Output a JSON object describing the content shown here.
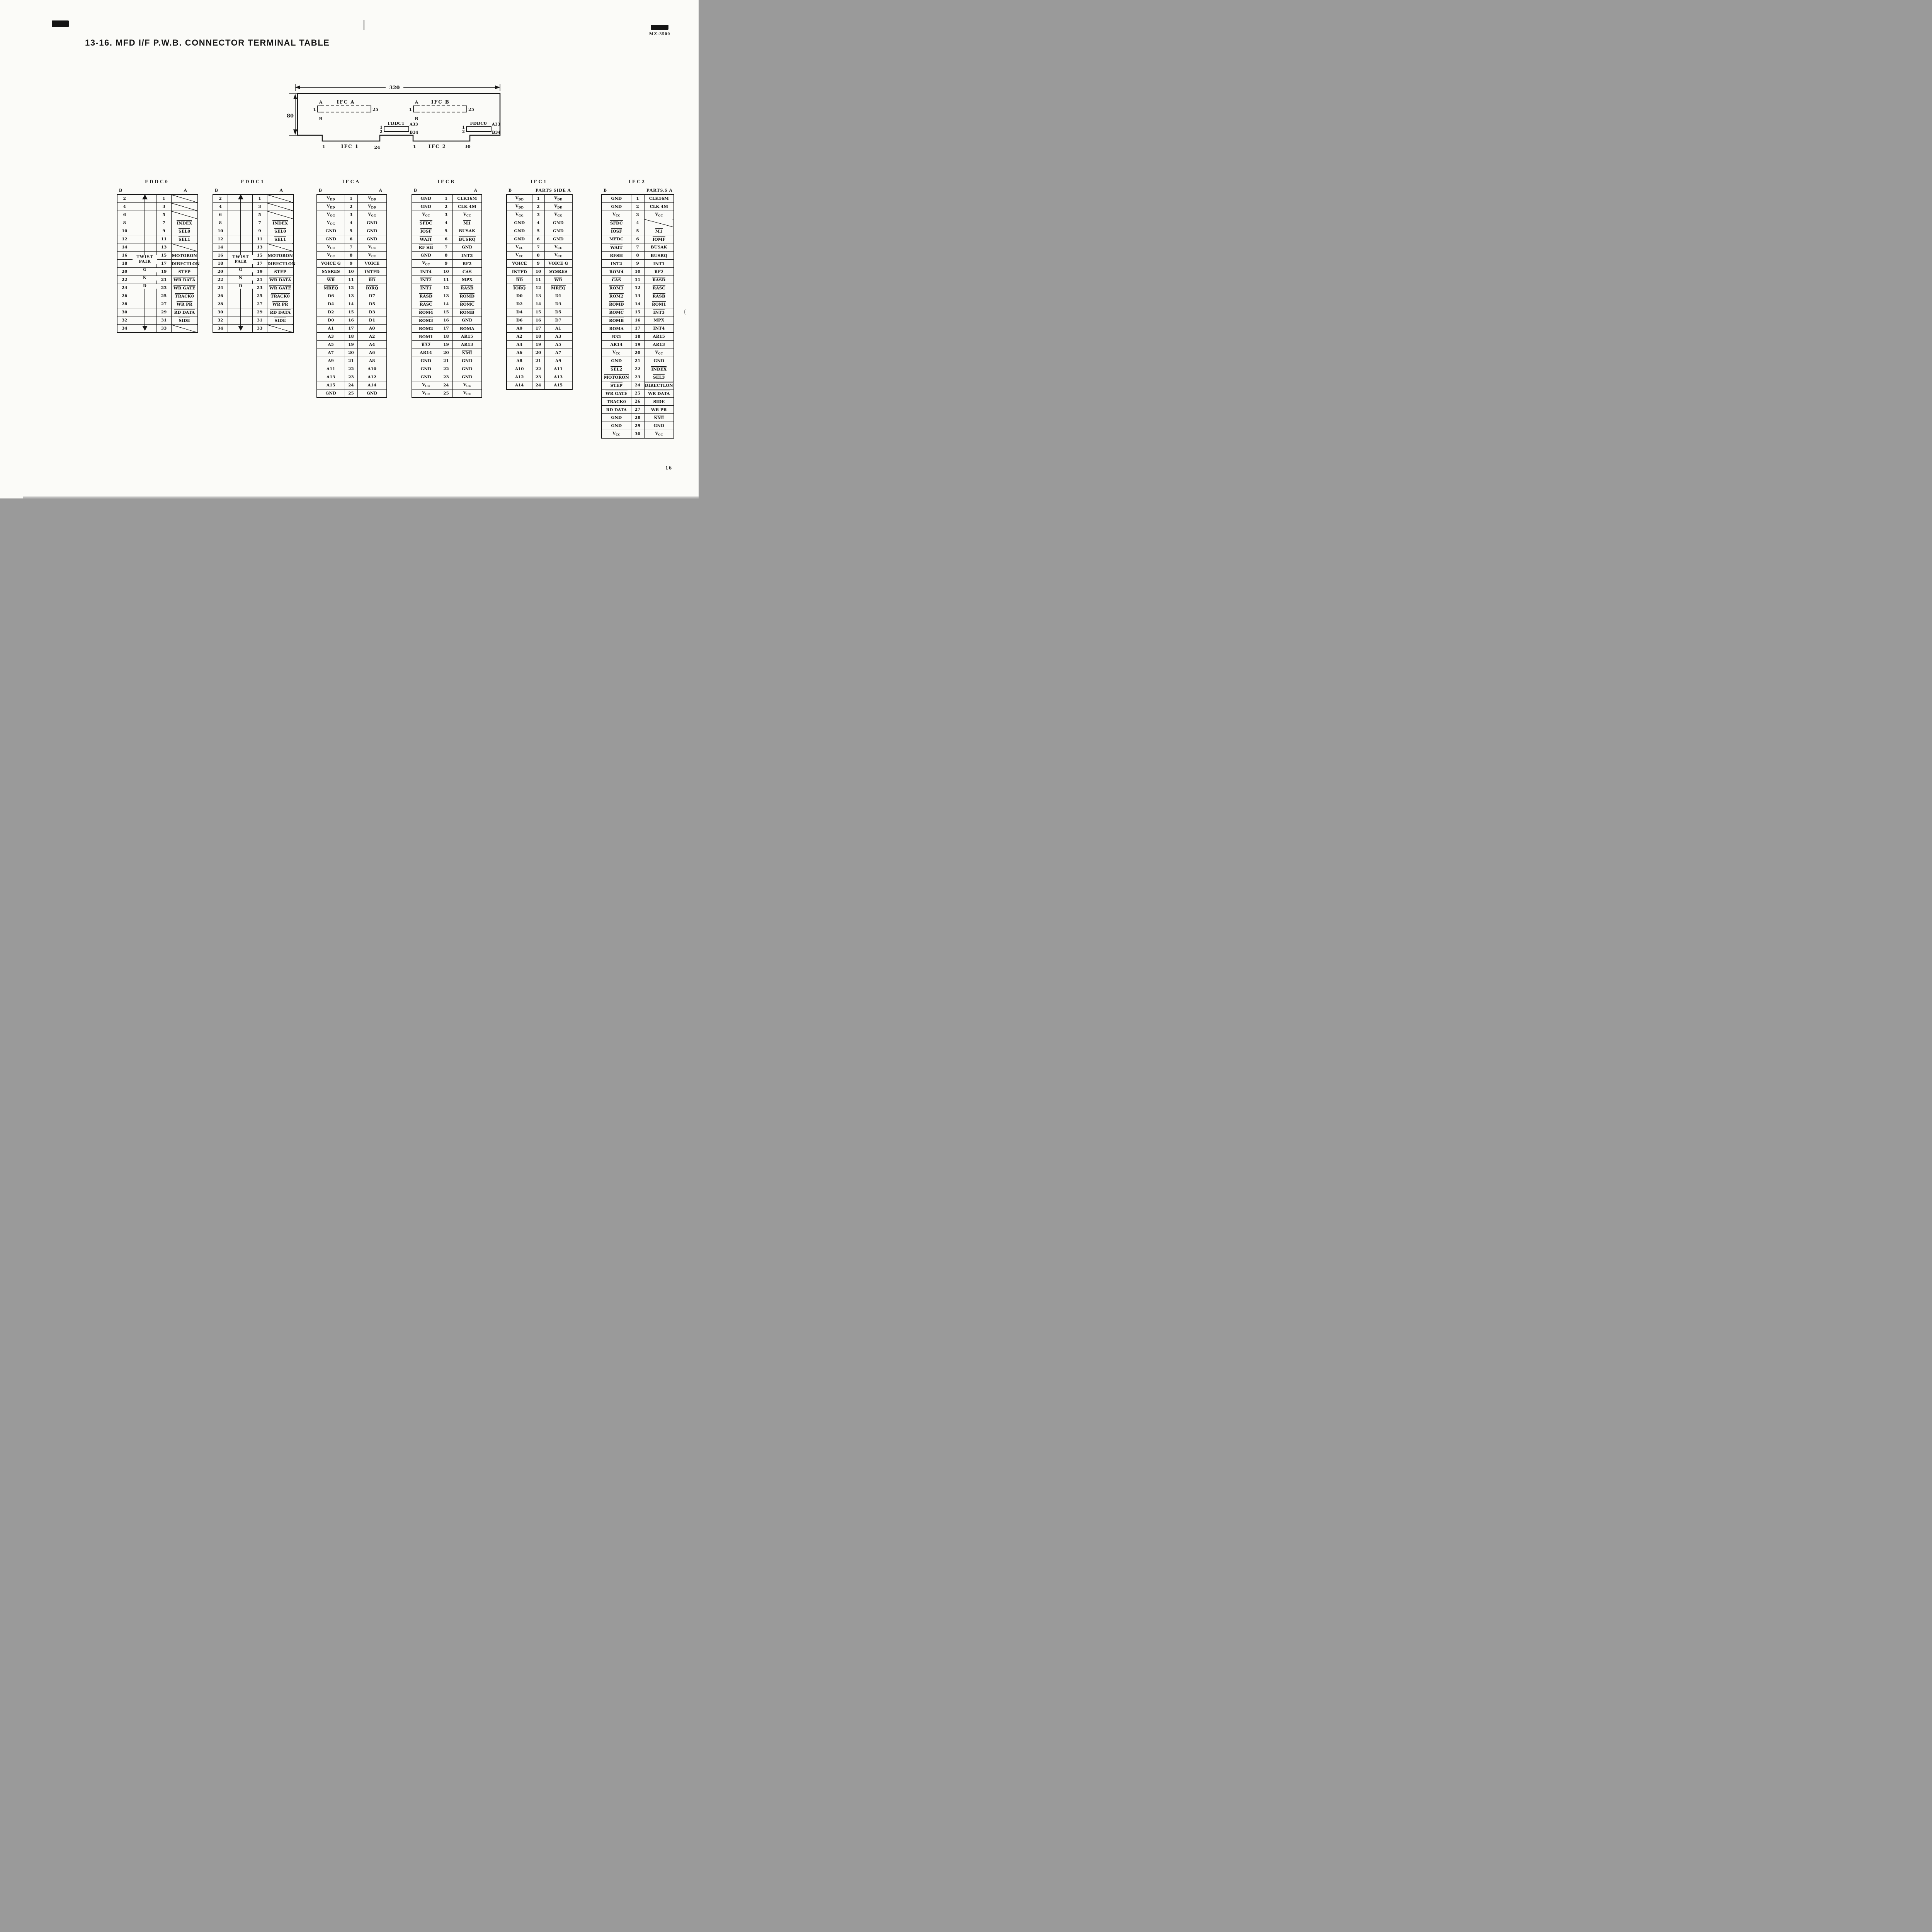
{
  "page": {
    "title": "13-16. MFD I/F P.W.B. CONNECTOR TERMINAL TABLE",
    "model": "MZ-3500",
    "page_number": "16"
  },
  "diagram": {
    "dim_width": "320",
    "dim_height": "80",
    "ifca": {
      "name": "IFC A",
      "side_a": "A",
      "side_b": "B",
      "pin_first": "1",
      "pin_last": "25"
    },
    "ifcb": {
      "name": "IFC B",
      "side_a": "A",
      "side_b": "B",
      "pin_first": "1",
      "pin_last": "25"
    },
    "fddc1": {
      "name": "FDDC1",
      "pin1": "1",
      "pin2": "2",
      "a33": "A33",
      "b34": "B34"
    },
    "fddc0": {
      "name": "FDDC0",
      "pin1": "1",
      "pin2": "2",
      "a33": "A33",
      "b34": "B34"
    },
    "ifc1": {
      "name": "IFC 1",
      "pin_first": "1",
      "pin_last": "24"
    },
    "ifc2": {
      "name": "IFC 2",
      "pin_first": "1",
      "pin_last": "30"
    }
  },
  "tables": [
    {
      "id": "fddc0",
      "kind": "fddc",
      "title": "FDDC0",
      "head_left": "B",
      "head_right": "A",
      "twist": {
        "line1": "TWIST",
        "line2": "PAIR",
        "g": "G",
        "n": "N",
        "d": "D"
      },
      "rows": [
        [
          "2",
          "1",
          "/"
        ],
        [
          "4",
          "3",
          "/"
        ],
        [
          "6",
          "5",
          "/"
        ],
        [
          "8",
          "7",
          "^INDEX"
        ],
        [
          "10",
          "9",
          "^SEL0"
        ],
        [
          "12",
          "11",
          "^SEL1"
        ],
        [
          "14",
          "13",
          "/"
        ],
        [
          "16",
          "15",
          "^MOTORON"
        ],
        [
          "18",
          "17",
          "^DIRECTLON"
        ],
        [
          "20",
          "19",
          "^STEP"
        ],
        [
          "22",
          "21",
          "^WR DATA"
        ],
        [
          "24",
          "23",
          "^WR GATE"
        ],
        [
          "26",
          "25",
          "^TRACK0"
        ],
        [
          "28",
          "27",
          "^WR PR"
        ],
        [
          "30",
          "29",
          "^RD DATA"
        ],
        [
          "32",
          "31",
          "^SIDE"
        ],
        [
          "34",
          "33",
          "/"
        ]
      ]
    },
    {
      "id": "fddc1",
      "kind": "fddc",
      "title": "FDDC1",
      "head_left": "B",
      "head_right": "A",
      "twist": {
        "line1": "TWIST",
        "line2": "PAIR",
        "g": "G",
        "n": "N",
        "d": "D"
      },
      "rows": [
        [
          "2",
          "1",
          "/"
        ],
        [
          "4",
          "3",
          "/"
        ],
        [
          "6",
          "5",
          "/"
        ],
        [
          "8",
          "7",
          "^INDEX"
        ],
        [
          "10",
          "9",
          "^SEL0"
        ],
        [
          "12",
          "11",
          "^SEL1"
        ],
        [
          "14",
          "13",
          "/"
        ],
        [
          "16",
          "15",
          "^MOTORON"
        ],
        [
          "18",
          "17",
          "^DIRECTLON"
        ],
        [
          "20",
          "19",
          "^STEP"
        ],
        [
          "22",
          "21",
          "^WR DATA"
        ],
        [
          "24",
          "23",
          "^WR GATE"
        ],
        [
          "26",
          "25",
          "^TRACK0"
        ],
        [
          "28",
          "27",
          "^WR PR"
        ],
        [
          "30",
          "29",
          "^RD DATA"
        ],
        [
          "32",
          "31",
          "^SIDE"
        ],
        [
          "34",
          "33",
          "/"
        ]
      ]
    },
    {
      "id": "ifca",
      "kind": "ifc",
      "title": "IFCA",
      "head_left": "B",
      "head_right": "A",
      "rows": [
        [
          "V_DD",
          "1",
          "V_DD"
        ],
        [
          "V_DD",
          "2",
          "V_DD"
        ],
        [
          "V_GG",
          "3",
          "V_GG"
        ],
        [
          "V_GG",
          "4",
          "GND"
        ],
        [
          "GND",
          "5",
          "GND"
        ],
        [
          "GND",
          "6",
          "GND"
        ],
        [
          "V_CC",
          "7",
          "V_CC"
        ],
        [
          "V_CC",
          "8",
          "V_CC"
        ],
        [
          "VOICE G",
          "9",
          "VOICE"
        ],
        [
          "SYSRES",
          "10",
          "^INTFD"
        ],
        [
          "^WR",
          "11",
          "^RD"
        ],
        [
          "^MREQ",
          "12",
          "^IORQ"
        ],
        [
          "D6",
          "13",
          "D7"
        ],
        [
          "D4",
          "14",
          "D5"
        ],
        [
          "D2",
          "15",
          "D3"
        ],
        [
          "D0",
          "16",
          "D1"
        ],
        [
          "A1",
          "17",
          "A0"
        ],
        [
          "A3",
          "18",
          "A2"
        ],
        [
          "A5",
          "19",
          "A4"
        ],
        [
          "A7",
          "20",
          "A6"
        ],
        [
          "A9",
          "21",
          "A8"
        ],
        [
          "A11",
          "22",
          "A10"
        ],
        [
          "A13",
          "23",
          "A12"
        ],
        [
          "A15",
          "24",
          "A14"
        ],
        [
          "GND",
          "25",
          "GND"
        ]
      ]
    },
    {
      "id": "ifcb",
      "kind": "ifc",
      "title": "IFCB",
      "head_left": "B",
      "head_right": "A",
      "rows": [
        [
          "GND",
          "1",
          "CLK16M"
        ],
        [
          "GND",
          "2",
          "CLK 4M"
        ],
        [
          "V_CC",
          "3",
          "V_CC"
        ],
        [
          "^SFDC",
          "4",
          "^M1"
        ],
        [
          "^IOSF",
          "5",
          "BUSAK"
        ],
        [
          "^WAIT",
          "6",
          "^BUSRQ"
        ],
        [
          "^RF SH",
          "7",
          "GND"
        ],
        [
          "GND",
          "8",
          "^INT3"
        ],
        [
          "V_CC",
          "9",
          "^RF2"
        ],
        [
          "^INT4",
          "10",
          "^CAS"
        ],
        [
          "^INT2",
          "11",
          "MPX"
        ],
        [
          "^INT1",
          "12",
          "^RASB"
        ],
        [
          "^RASD",
          "13",
          "^ROMD"
        ],
        [
          "^RASC",
          "14",
          "^ROMC"
        ],
        [
          "^ROM4",
          "15",
          "^ROMB"
        ],
        [
          "^ROM3",
          "16",
          "GND"
        ],
        [
          "^ROM2",
          "17",
          "^ROMA"
        ],
        [
          "^ROM1",
          "18",
          "AR15"
        ],
        [
          "^R32",
          "19",
          "AR13"
        ],
        [
          "AR14",
          "20",
          "^NMI"
        ],
        [
          "GND",
          "21",
          "GND"
        ],
        [
          "GND",
          "22",
          "GND"
        ],
        [
          "GND",
          "23",
          "GND"
        ],
        [
          "V_CC",
          "24",
          "V_CC"
        ],
        [
          "V_CC",
          "25",
          "V_CC"
        ]
      ]
    },
    {
      "id": "ifc1",
      "kind": "ifc",
      "title": "IFC1",
      "head_left": "B",
      "head_right": "PARTS SIDE A",
      "rows": [
        [
          "V_DD",
          "1",
          "V_DD"
        ],
        [
          "V_DD",
          "2",
          "V_DD"
        ],
        [
          "V_GG",
          "3",
          "V_GG"
        ],
        [
          "GND",
          "4",
          "GND"
        ],
        [
          "GND",
          "5",
          "GND"
        ],
        [
          "GND",
          "6",
          "GND"
        ],
        [
          "V_CC",
          "7",
          "V_CC"
        ],
        [
          "V_CC",
          "8",
          "V_CC"
        ],
        [
          "VOICE",
          "9",
          "VOICE G"
        ],
        [
          "^INTFD",
          "10",
          "SYSRES"
        ],
        [
          "^RD",
          "11",
          "^WR"
        ],
        [
          "^IORQ",
          "12",
          "^MREQ"
        ],
        [
          "D0",
          "13",
          "D1"
        ],
        [
          "D2",
          "14",
          "D3"
        ],
        [
          "D4",
          "15",
          "D5"
        ],
        [
          "D6",
          "16",
          "D7"
        ],
        [
          "A0",
          "17",
          "A1"
        ],
        [
          "A2",
          "18",
          "A3"
        ],
        [
          "A4",
          "19",
          "A5"
        ],
        [
          "A6",
          "20",
          "A7"
        ],
        [
          "A8",
          "21",
          "A9"
        ],
        [
          "A10",
          "22",
          "A11"
        ],
        [
          "A12",
          "23",
          "A13"
        ],
        [
          "A14",
          "24",
          "A15"
        ]
      ]
    },
    {
      "id": "ifc2",
      "kind": "ifc",
      "title": "IFC2",
      "head_left": "B",
      "head_right": "PARTS.S A",
      "rows": [
        [
          "GND",
          "1",
          "CLK16M"
        ],
        [
          "GND",
          "2",
          "CLK 4M"
        ],
        [
          "V_CC",
          "3",
          "V_CC"
        ],
        [
          "^SFDC",
          "4",
          "/"
        ],
        [
          "^IOSF",
          "5",
          "^M1"
        ],
        [
          "MFDC",
          "6",
          "^IOMF"
        ],
        [
          "^WAIT",
          "7",
          "BUSAK"
        ],
        [
          "^RFSH",
          "8",
          "^BUSRQ"
        ],
        [
          "^INT2",
          "9",
          "^INT1"
        ],
        [
          "^ROM4",
          "10",
          "^RF2"
        ],
        [
          "^CAS",
          "11",
          "^RASD"
        ],
        [
          "^ROM3",
          "12",
          "^RASC"
        ],
        [
          "^ROM2",
          "13",
          "^RASB"
        ],
        [
          "^ROMD",
          "14",
          "^ROM1"
        ],
        [
          "^ROMC",
          "15",
          "^INT3"
        ],
        [
          "^ROMB",
          "16",
          "MPX"
        ],
        [
          "^ROMA",
          "17",
          "INT4"
        ],
        [
          "^R32",
          "18",
          "AR15"
        ],
        [
          "AR14",
          "19",
          "AR13"
        ],
        [
          "V_CC",
          "20",
          "V_CC"
        ],
        [
          "GND",
          "21",
          "GND"
        ],
        [
          "^SEL2",
          "22",
          "^INDEX"
        ],
        [
          "^MOTORON",
          "23",
          "^SEL3"
        ],
        [
          "^STEP",
          "24",
          "^DIRECTLON"
        ],
        [
          "^WR GATE",
          "25",
          "^WR DATA"
        ],
        [
          "^TRACK0",
          "26",
          "^SIDE"
        ],
        [
          "^RD DATA",
          "27",
          "^WR PR"
        ],
        [
          "GND",
          "28",
          "^NMI"
        ],
        [
          "GND",
          "29",
          "GND"
        ],
        [
          "V_CC",
          "30",
          "V_CC"
        ]
      ]
    }
  ],
  "stray_mark": "("
}
